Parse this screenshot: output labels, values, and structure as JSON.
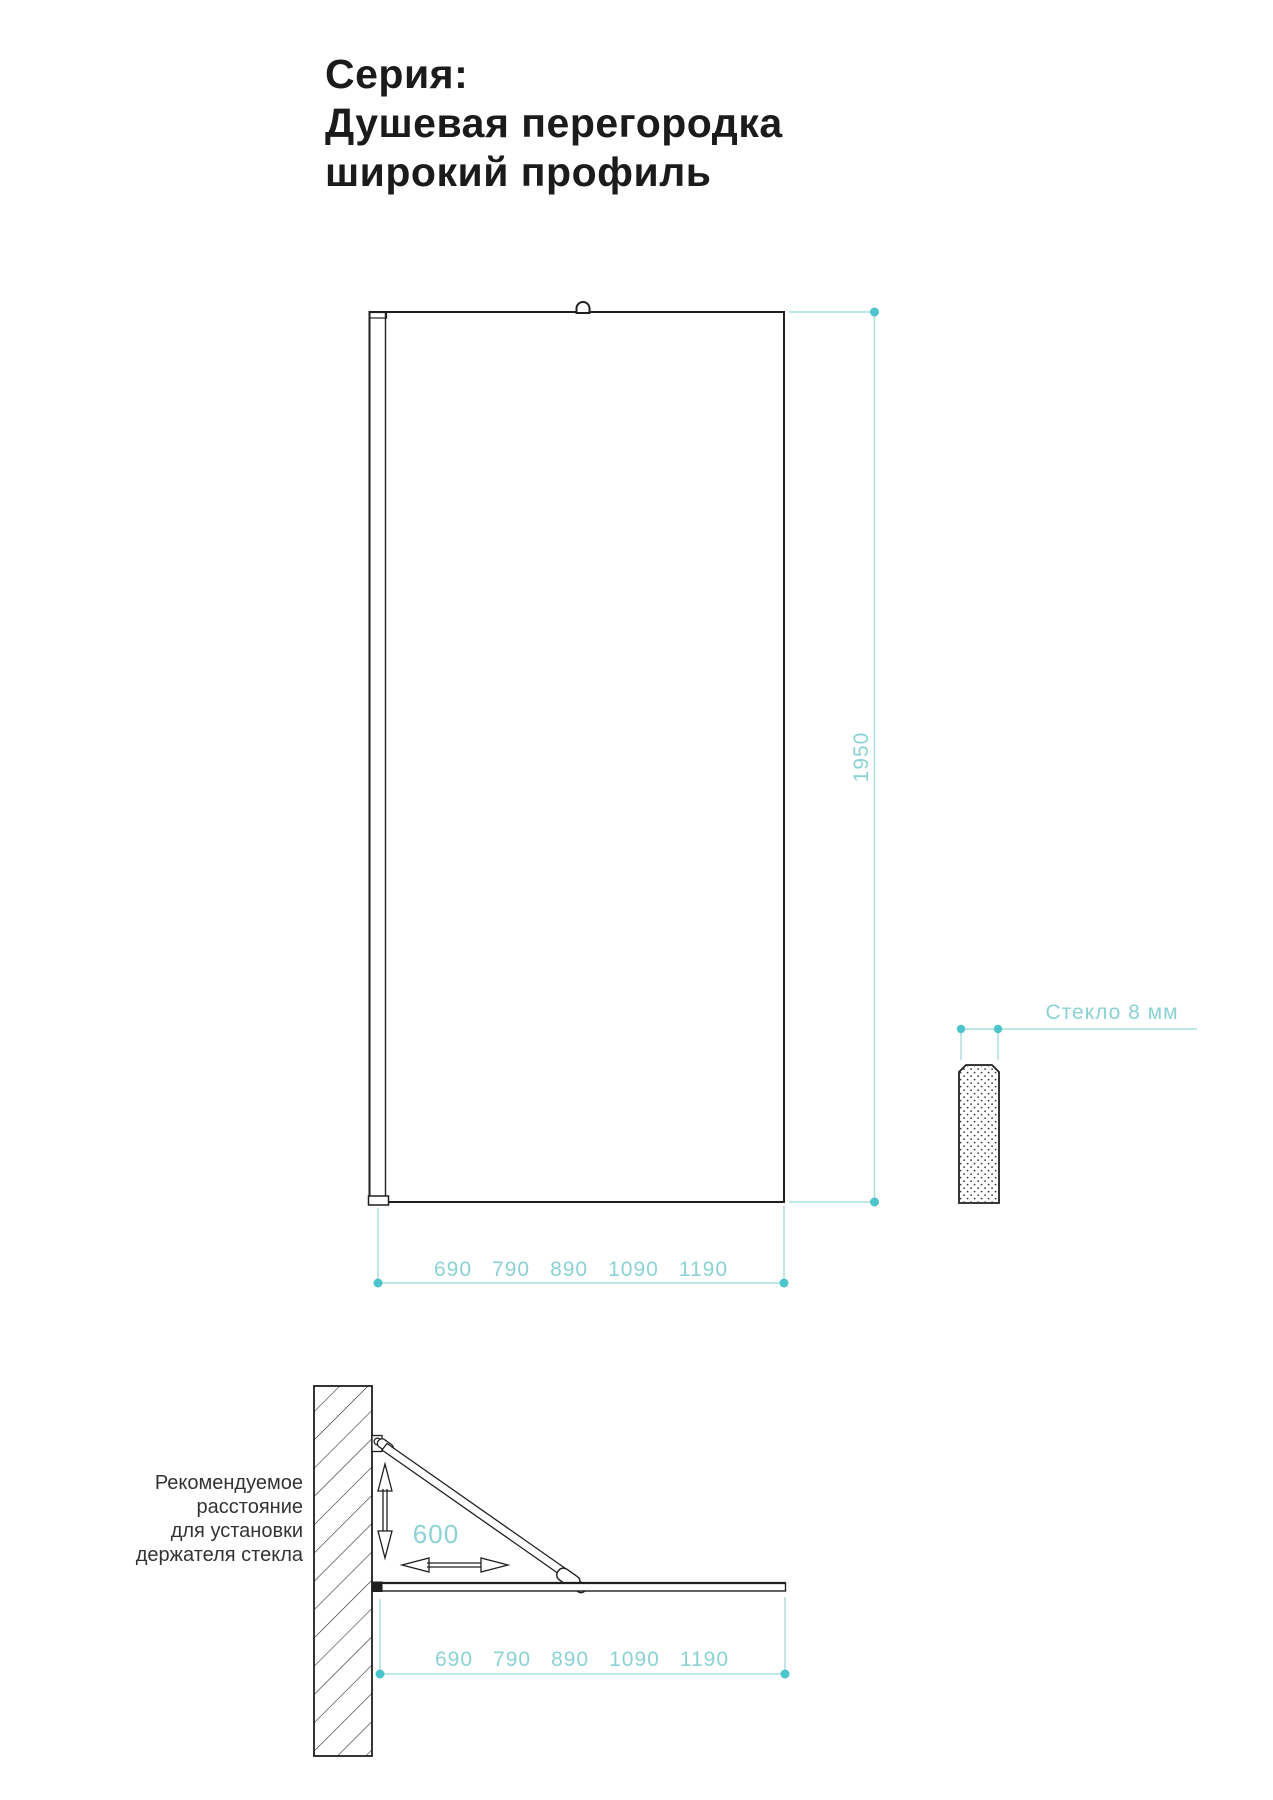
{
  "title": {
    "line1": "Серия:",
    "line2": "Душевая перегородка",
    "line3": "широкий профиль"
  },
  "front_view": {
    "height_label": "1950",
    "widths": [
      "690",
      "790",
      "890",
      "1090",
      "1190"
    ]
  },
  "glass_detail": {
    "label": "Стекло 8 мм"
  },
  "side_view": {
    "distance_label": "600",
    "widths": [
      "690",
      "790",
      "890",
      "1090",
      "1190"
    ],
    "note": {
      "l1": "Рекомендуемое",
      "l2": "расстояние",
      "l3": "для установки",
      "l4": "держателя стекла"
    }
  },
  "colors": {
    "ink": "#1f1f1f",
    "teal_line": "#aadde0",
    "teal_dot": "#4cc5cc",
    "teal_text": "#8cd2d4",
    "background": "#ffffff"
  }
}
